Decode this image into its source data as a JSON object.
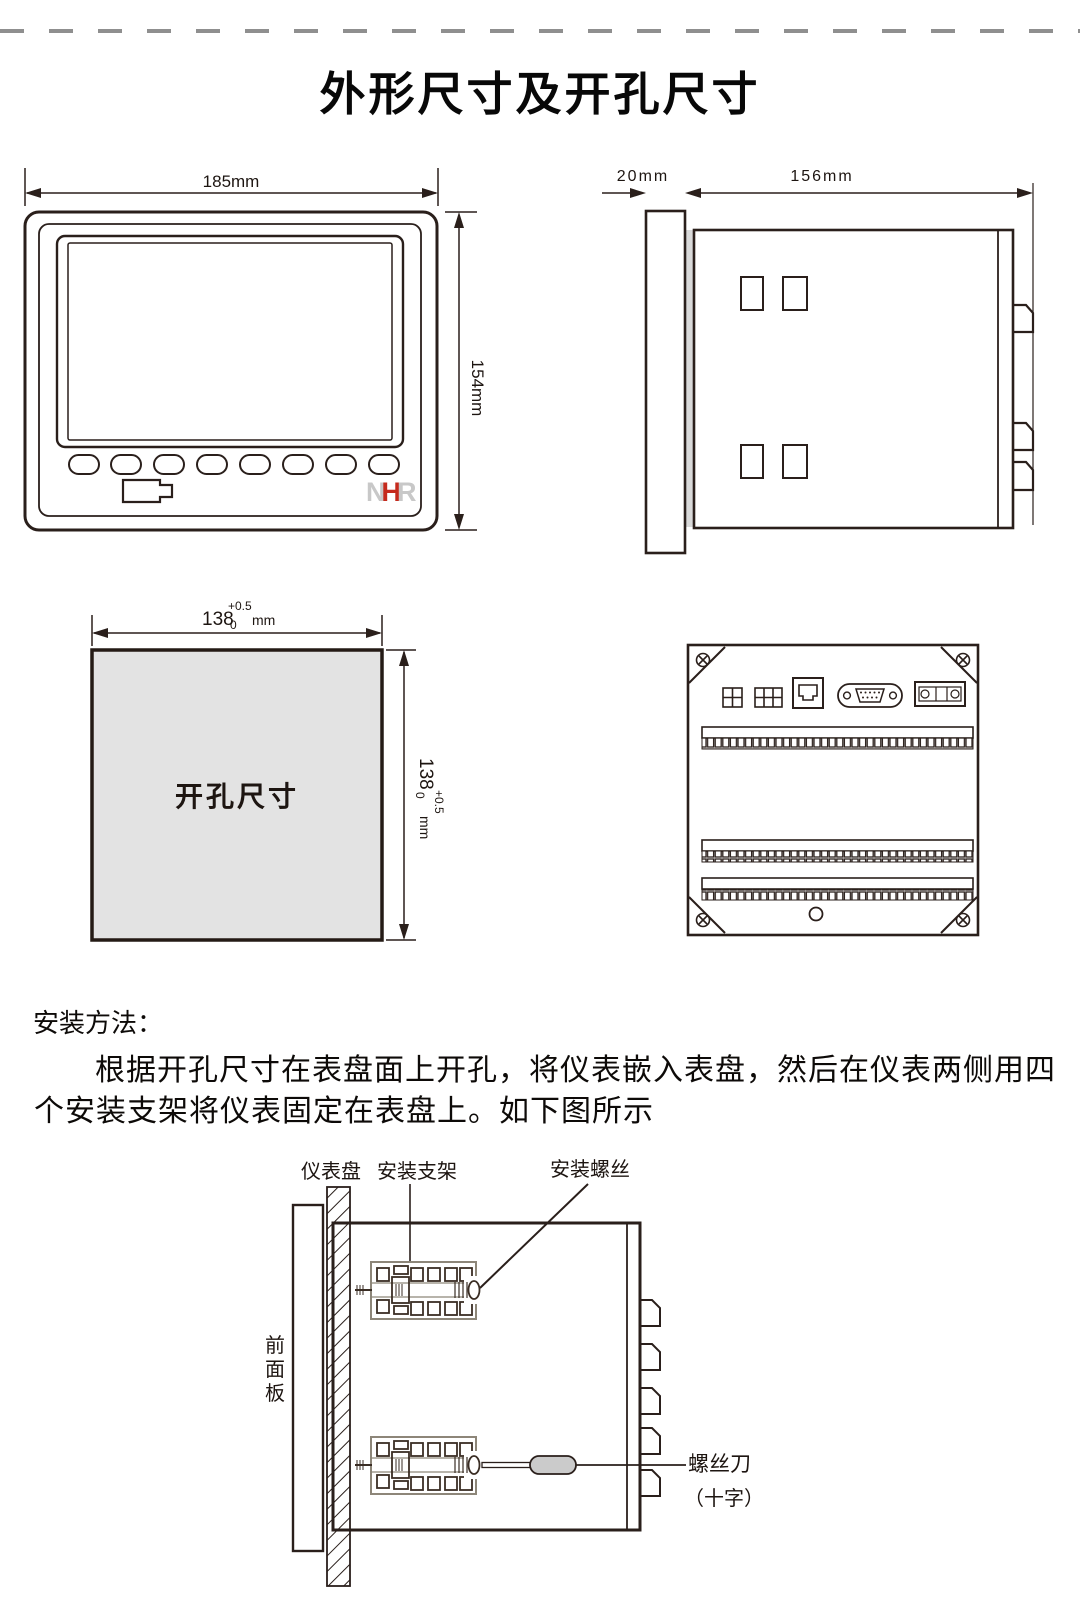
{
  "page": {
    "title": "外形尺寸及开孔尺寸"
  },
  "front_view": {
    "width_label": "185mm",
    "height_label": "154mm",
    "logo_n": "N",
    "logo_h": "H",
    "logo_r": "R"
  },
  "side_view": {
    "depth_label": "20mm",
    "length_label": "156mm"
  },
  "cutout": {
    "label": "开孔尺寸",
    "width_dim": {
      "value": "138",
      "tol_sup": "+0.5",
      "tol_sub": "0",
      "unit": "mm"
    },
    "height_dim": {
      "value": "138",
      "tol_sup": "+0.5",
      "tol_sub": "0",
      "unit": "mm"
    }
  },
  "install": {
    "heading": "安装方法：",
    "para_line1": "根据开孔尺寸在表盘面上开孔，将仪表嵌入表盘，然后在仪表两侧用四",
    "para_line2": "个安装支架将仪表固定在表盘上。如下图所示",
    "label_panel": "仪表盘",
    "label_bracket": "安装支架",
    "label_screw": "安装螺丝",
    "front_panel_chars": [
      "前",
      "面",
      "板"
    ],
    "label_screwdriver": "螺丝刀",
    "label_screwdriver_type": "（十字）"
  }
}
